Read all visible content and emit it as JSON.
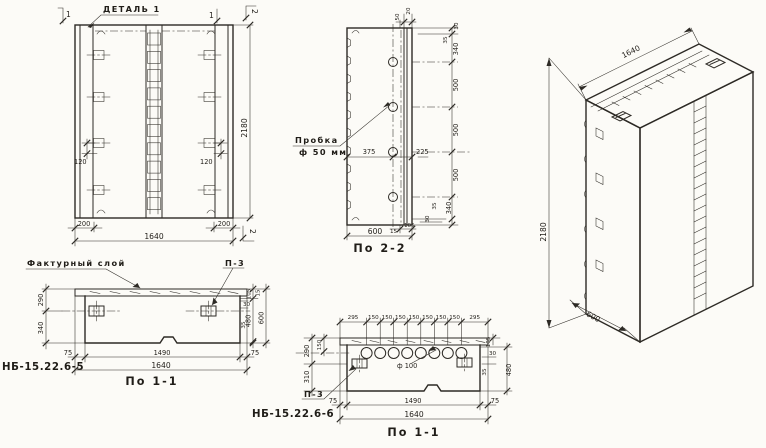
{
  "drawing": {
    "front_view": {
      "detail_callout": "ДЕТАЛЬ 1",
      "section_flag_1a": "1",
      "section_flag_1b": "1",
      "section_flag_2_top": "2",
      "section_flag_2_bottom": "2",
      "dim_height": "2180",
      "dim_edge_left": "200",
      "dim_edge_right": "200",
      "dim_width": "1640",
      "dim_loop_left": "120",
      "dim_loop_right": "120"
    },
    "section_2_2": {
      "caption": "По 2-2",
      "plug_label_line1": "Пробка",
      "plug_label_line2": "ф 50 мм",
      "dim_hole_left": "375",
      "dim_hole_right": "225",
      "dim_top_a": "50",
      "dim_top_b": "20",
      "chain": [
        "30",
        "35",
        "340",
        "500",
        "500",
        "500",
        "340",
        "35",
        "30"
      ],
      "dim_bottom_a": "15",
      "dim_bottom_b": "105",
      "dim_width": "600"
    },
    "iso_view": {
      "dim_width": "1640",
      "dim_height": "2180",
      "dim_depth": "600"
    },
    "section_1_1_left": {
      "mark": "НБ-15.22.6-5",
      "caption": "По 1-1",
      "facing_label": "Фактурный слой",
      "plate_label": "П-3",
      "dim_290": "290",
      "dim_340": "340",
      "dim_105": "105",
      "dim_15": "15",
      "dim_30": "30",
      "dim_35": "35",
      "dim_480": "480",
      "dim_600": "600",
      "dim_edge_left": "75",
      "dim_inner": "1490",
      "dim_edge_right": "75",
      "dim_width": "1640"
    },
    "section_1_1_right": {
      "mark": "НБ-15.22.6-6",
      "caption": "По 1-1",
      "plate_label": "П-3",
      "hole_label": "ф 100",
      "top_chain": [
        "295",
        "150",
        "150",
        "150",
        "150",
        "150",
        "150",
        "150",
        "295"
      ],
      "dim_150": "150",
      "dim_290": "290",
      "dim_310": "310",
      "dim_105": "105",
      "dim_30": "30",
      "dim_35": "35",
      "dim_480": "480",
      "dim_edge_left": "75",
      "dim_inner": "1490",
      "dim_edge_right": "75",
      "dim_width": "1640"
    }
  }
}
